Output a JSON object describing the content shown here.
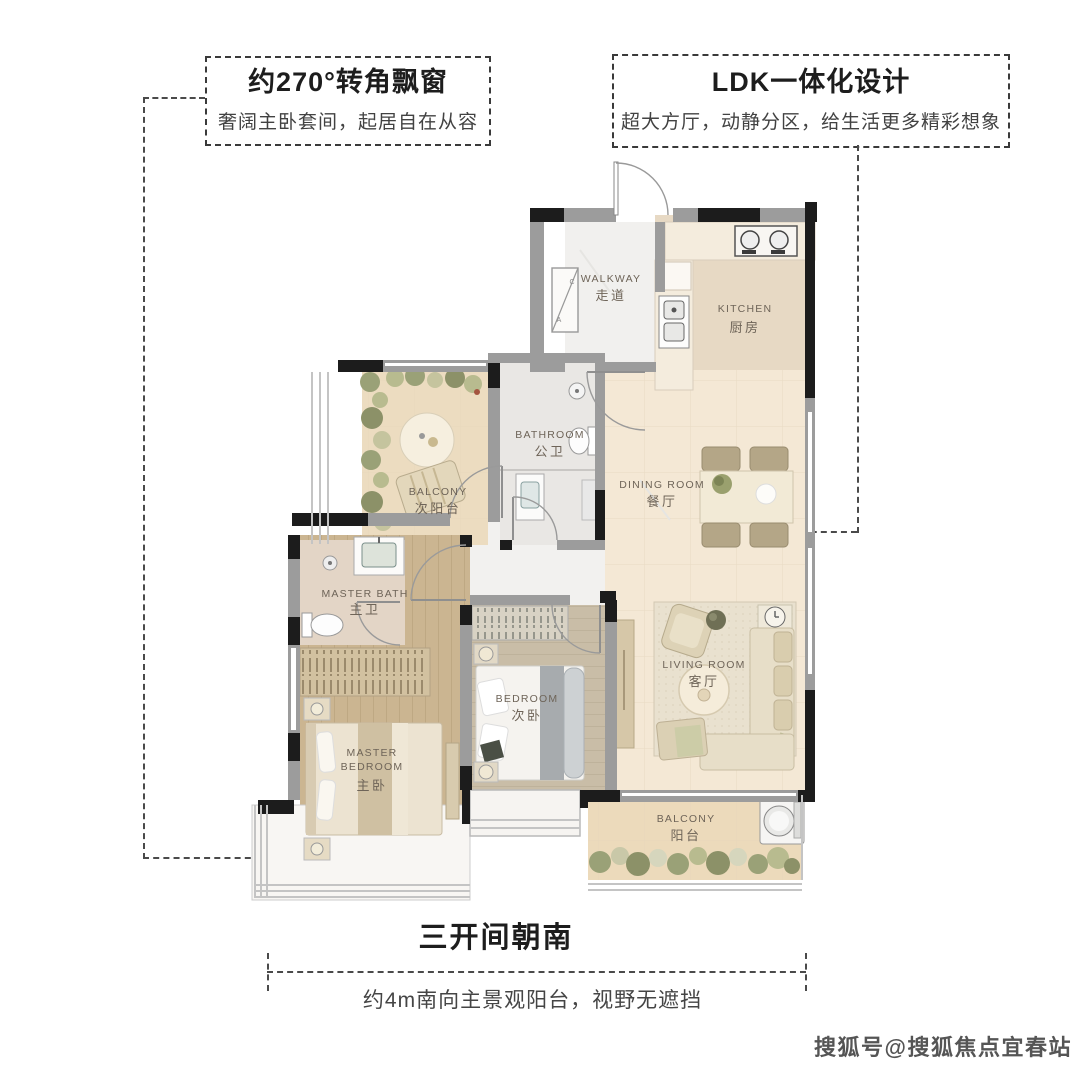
{
  "page": {
    "width": 1080,
    "height": 1073,
    "background": "#ffffff"
  },
  "callouts": {
    "top_left": {
      "title": "约270°转角飘窗",
      "subtitle": "奢阔主卧套间，起居自在从容"
    },
    "top_right": {
      "title": "LDK一体化设计",
      "subtitle": "超大方厅，动静分区，给生活更多精彩想象"
    },
    "bottom": {
      "title": "三开间朝南",
      "subtitle": "约4m南向主景观阳台，视野无遮挡"
    }
  },
  "floor_plan": {
    "rooms": {
      "walkway": {
        "en": "WALKWAY",
        "cn": "走道"
      },
      "kitchen": {
        "en": "KITCHEN",
        "cn": "厨房"
      },
      "bathroom": {
        "en": "BATHROOM",
        "cn": "公卫"
      },
      "balcony_north": {
        "en": "BALCONY",
        "cn": "次阳台"
      },
      "dining": {
        "en": "DINING ROOM",
        "cn": "餐厅"
      },
      "master_bath": {
        "en": "MASTER BATH",
        "cn": "主卫"
      },
      "bedroom": {
        "en": "BEDROOM",
        "cn": "次卧"
      },
      "living": {
        "en": "LIVING ROOM",
        "cn": "客厅"
      },
      "master_bedroom": {
        "en1": "MASTER",
        "en2": "BEDROOM",
        "cn": "主卧"
      },
      "balcony_south": {
        "en": "BALCONY",
        "cn": "阳台"
      }
    },
    "shaft": {
      "a": "A",
      "c": "C"
    }
  },
  "watermark": {
    "text": "搜狐号@搜狐焦点宜春站"
  },
  "palette": {
    "ink": "#262626",
    "wall_gray": "#9c9c9c",
    "floor_beige": "#f4e8d5",
    "wood": "#cbb591",
    "marble": "#f1f0ee",
    "plant_green": "#9aa177",
    "label_text": "#6e6458",
    "leader": "#4a4a4a"
  }
}
